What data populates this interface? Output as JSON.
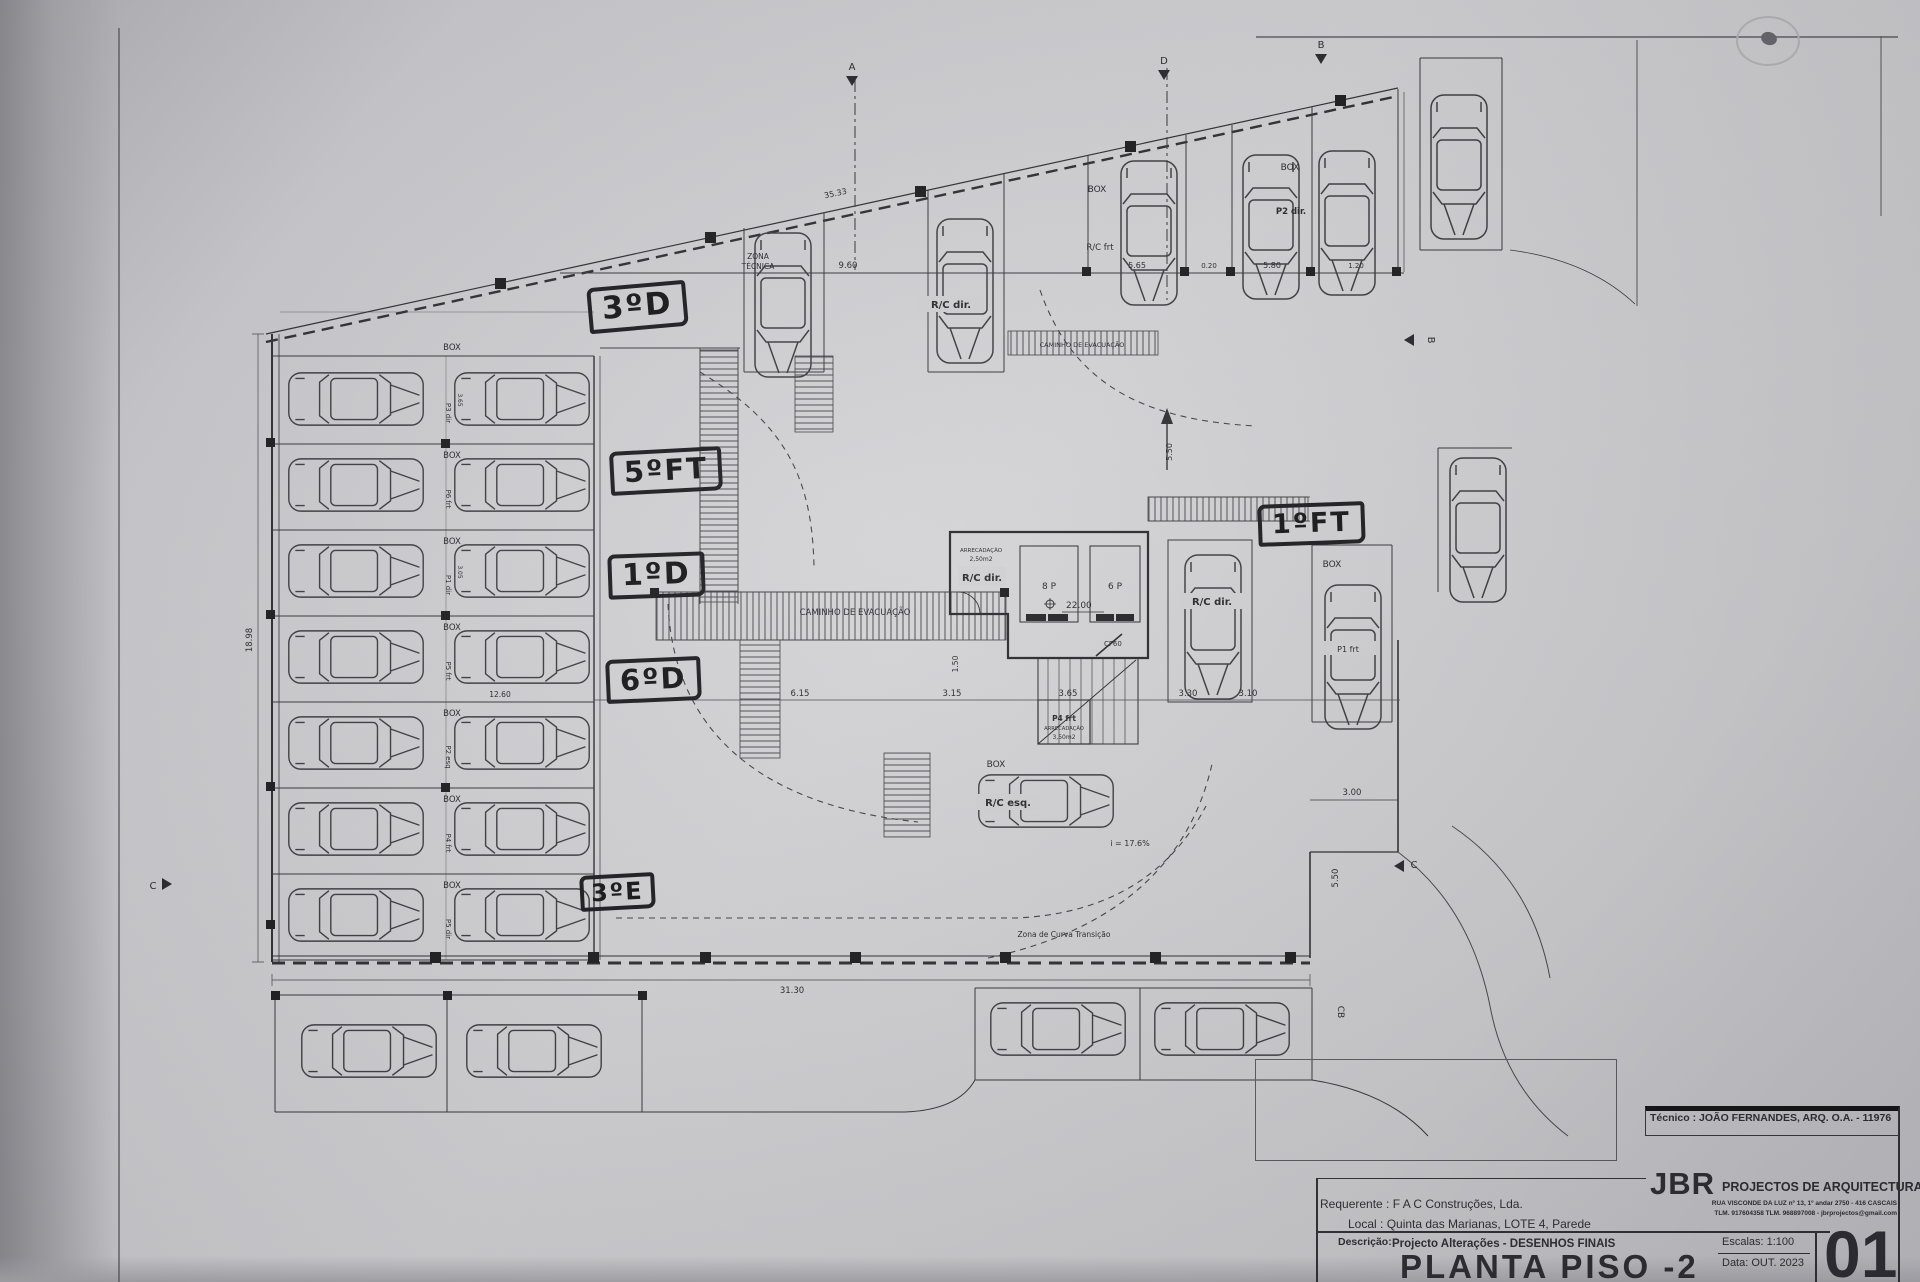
{
  "titleblock": {
    "tecnico": "Técnico : JOÃO FERNANDES, ARQ.   O.A. - 11976",
    "firm": "JBR",
    "firm_tagline": "PROJECTOS DE ARQUITECTURA",
    "firm_addr1": "RUA VISCONDE DA LUZ nº 13, 1º andar  2750 - 416  CASCAIS",
    "firm_addr2": "TLM. 917604358  TLM. 968897008 - jbrprojectos@gmail.com",
    "requerente": "Requerente : F A C  Construções, Lda.",
    "local": "Local : Quinta das Marianas, LOTE 4, Parede",
    "descricao_label": "Descrição:",
    "descricao_value": "Projecto Alterações - DESENHOS FINAIS",
    "drawing_title": "PLANTA PISO -2",
    "escalas": "Escalas:  1:100",
    "data": "Data: OUT.  2023",
    "sheet_number": "01"
  },
  "annotations": {
    "unit_3d": "3ºD",
    "unit_5ft": "5ºFT",
    "unit_1d": "1ºD",
    "unit_6d": "6ºD",
    "unit_3e": "3ºE",
    "unit_1ft": "1ºFT"
  },
  "plan": {
    "zona_tecnica_1": "ZONA",
    "zona_tecnica_2": "TÉCNICA",
    "caminho_evacuacao": "CAMINHO  DE  EVACUAÇÃO",
    "box": "BOX",
    "rc_dir": "R/C dir.",
    "rc_esq": "R/C esq.",
    "rc_frt": "R/C frt",
    "p2_dir": "P2 dir.",
    "p1_frt": "P1 frt",
    "p4_frt": "P4 frt",
    "arrecadacao": "ARRECADAÇÃO",
    "area_small": "2,50m2",
    "area_large": "3,50m2",
    "elevator_8p": "8 P",
    "elevator_6p": "6 P",
    "door_cf60": "CF60",
    "level_value": "22.00",
    "ramp_slope": "i = 17.6%",
    "curve_note": "Zona de Curva Transição",
    "parking_rows": [
      {
        "stall": "P3 dir"
      },
      {
        "stall": "P6 frt"
      },
      {
        "stall": "P1 dir"
      },
      {
        "stall": "P5 frt"
      },
      {
        "stall": "P2 esq"
      },
      {
        "stall": "P4 frt"
      },
      {
        "stall": "P5 dir"
      }
    ],
    "dims": {
      "top_total": "35.33",
      "top_a": "9.60",
      "top_b": "5.65",
      "top_c": "0.20",
      "top_d": "5.80",
      "top_e": "1.20",
      "left_total": "18.98",
      "stall1": "3.65",
      "stall3": "3.05",
      "mid_span": "12.60",
      "mid_a": "6.15",
      "mid_b": "3.15",
      "mid_c": "3.65",
      "mid_d": "3.30",
      "mid_e": "3.10",
      "core_h": "1.50",
      "right_a": "3.00",
      "right_b": "5.50",
      "right_top": "5.50",
      "bottom_total": "31.30"
    },
    "sections": {
      "a": "A",
      "b": "B",
      "c": "C",
      "d": "D",
      "cb": "CB"
    }
  }
}
